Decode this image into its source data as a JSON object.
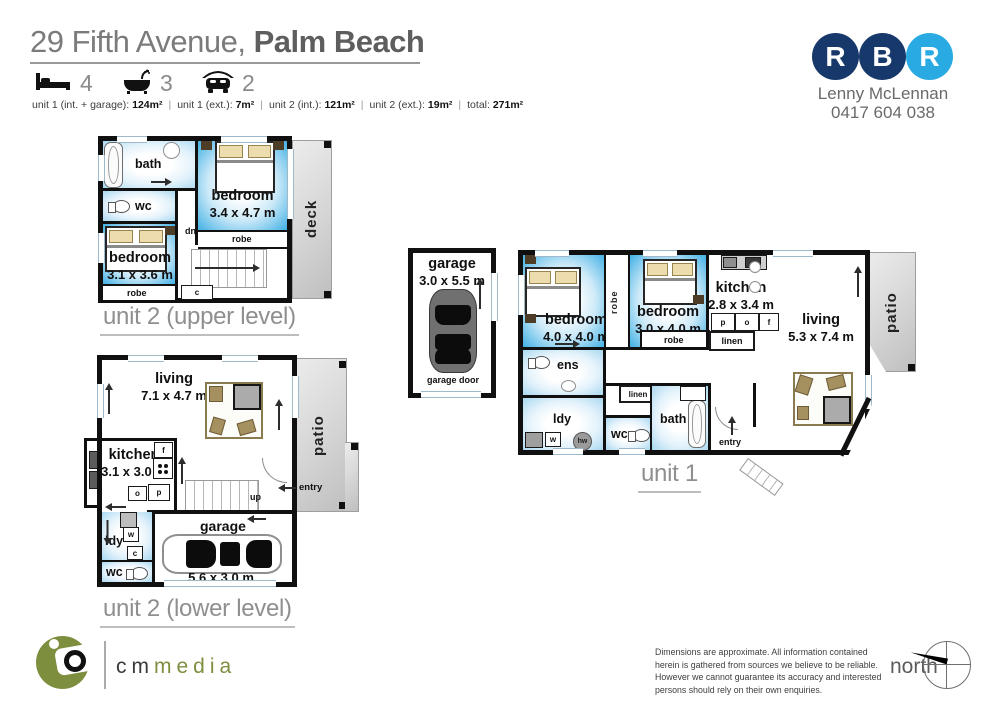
{
  "header": {
    "title_regular": "29 Fifth Avenue,",
    "title_bold": "Palm Beach",
    "separator": "|",
    "features": {
      "beds": "4",
      "baths": "3",
      "cars": "2"
    },
    "stats": [
      {
        "label": "unit 1 (int. + garage): ",
        "value": "124m²"
      },
      {
        "label": "unit 1 (ext.): ",
        "value": "7m²"
      },
      {
        "label": "unit 2 (int.): ",
        "value": "121m²"
      },
      {
        "label": "unit 2 (ext.): ",
        "value": "19m²"
      },
      {
        "label": "total: ",
        "value": "271m²"
      }
    ]
  },
  "agent": {
    "letters": [
      "R",
      "B",
      "R"
    ],
    "colors": {
      "navy": "#16386a",
      "light_blue": "#2aaae2"
    },
    "name": "Lenny McLennan",
    "phone": "0417 604 038"
  },
  "plans": {
    "u2u": {
      "caption": "unit 2 (upper level)",
      "bath": "bath",
      "wc": "wc",
      "bed1name": "bedroom",
      "bed1dims": "3.1 x 3.6 m",
      "bed2name": "bedroom",
      "bed2dims": "3.4 x 4.7 m",
      "deck": "deck",
      "robe": "robe",
      "dn": "dn",
      "c": "c"
    },
    "g1": {
      "name": "garage",
      "dims": "3.0 x 5.5 m",
      "door": "garage door"
    },
    "u1": {
      "caption": "unit 1",
      "bed1name": "bedroom",
      "bed1dims": "4.0 x 4.0 m",
      "bed2name": "bedroom",
      "bed2dims": "3.0 x 4.0 m",
      "robe": "robe",
      "kitchenname": "kitchen",
      "kitchendims": "2.8 x 3.4 m",
      "livingname": "living",
      "livingdims": "5.3 x 7.4 m",
      "patio": "patio",
      "ens": "ens",
      "ldy": "ldy",
      "wc": "wc",
      "bath": "bath",
      "linen": "linen",
      "entry": "entry",
      "p": "p",
      "o": "o",
      "f": "f",
      "w": "w",
      "hw": "hw"
    },
    "u2l": {
      "caption": "unit 2 (lower level)",
      "livingname": "living",
      "livingdims": "7.1 x 4.7 m",
      "kitchenname": "kitchen",
      "kitchendims": "3.1 x 3.0 m",
      "garagename": "garage",
      "garagedims": "5.6 x 3.0 m",
      "patio": "patio",
      "ldy": "ldy",
      "wc": "wc",
      "entry": "entry",
      "up": "up",
      "f": "f",
      "o": "o",
      "p": "p",
      "w": "w",
      "c": "c"
    }
  },
  "footer": {
    "brand_prefix": "cm",
    "brand_suffix": "media",
    "disclaimer": "Dimensions are approximate.  All information contained herein is gathered from sources we believe to be reliable.  However we cannot guarantee its accuracy and interested persons should rely on their own enquiries.",
    "north": "north"
  }
}
